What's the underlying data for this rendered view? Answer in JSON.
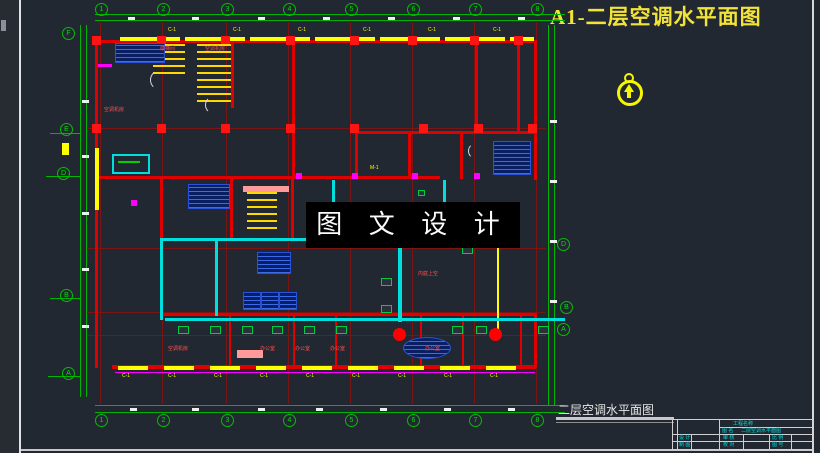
{
  "sheet": {
    "title": "A1-二层空调水平面图",
    "plan_caption": "二层空调水平面图",
    "background": "#222831",
    "accent_yellow": "#f2e338",
    "accent_green": "#00b400",
    "accent_red": "#e00000",
    "accent_cyan": "#00dede"
  },
  "watermark": {
    "text": "图 文 设 计"
  },
  "north_arrow": {
    "name": "north-arrow",
    "color": "#f6f600"
  },
  "title_block": {
    "project_label": "工程名称",
    "name_label": "图 名",
    "drawing_name": "二层空调水平面图",
    "design_label": "设 计",
    "draft_label": "制 图",
    "check_label": "审 核",
    "proof_label": "校 对",
    "scale_label": "比 例",
    "number_label": "图 号"
  },
  "axes": {
    "top_y": 3,
    "bottom_y": 414,
    "top": [
      "1",
      "2",
      "3",
      "4",
      "5",
      "6",
      "7",
      "8"
    ],
    "top_x": [
      95,
      157,
      221,
      283,
      345,
      407,
      469,
      531
    ],
    "left": [
      {
        "x": 62,
        "y": 27,
        "t": "F"
      },
      {
        "x": 60,
        "y": 123,
        "t": "E"
      },
      {
        "x": 57,
        "y": 167,
        "t": "D"
      },
      {
        "x": 60,
        "y": 289,
        "t": "B"
      },
      {
        "x": 62,
        "y": 367,
        "t": "A"
      }
    ],
    "right": [
      {
        "x": 557,
        "y": 238,
        "t": "D"
      },
      {
        "x": 560,
        "y": 301,
        "t": "B"
      },
      {
        "x": 557,
        "y": 323,
        "t": "A"
      }
    ]
  },
  "plan": {
    "vgrid": {
      "x": [
        100,
        162,
        226,
        288,
        350,
        412,
        474,
        536
      ],
      "y1": 22,
      "y2": 404
    },
    "hgrid": {
      "y": [
        128,
        248,
        312,
        335
      ],
      "x1": 88,
      "x2": 546
    },
    "shapes": [
      {
        "c": "gl",
        "b": [
          95,
          14,
          470,
          1
        ]
      },
      {
        "c": "gl",
        "b": [
          95,
          20,
          470,
          1
        ]
      },
      {
        "c": "gl",
        "b": [
          95,
          405,
          470,
          1
        ]
      },
      {
        "c": "gl",
        "b": [
          95,
          412,
          470,
          1
        ]
      },
      {
        "c": "gl",
        "b": [
          80,
          25,
          1,
          372
        ]
      },
      {
        "c": "gl",
        "b": [
          86,
          25,
          1,
          372
        ]
      },
      {
        "c": "gl",
        "b": [
          548,
          25,
          1,
          380
        ]
      },
      {
        "c": "gl",
        "b": [
          554,
          25,
          1,
          380
        ]
      },
      {
        "c": "gl",
        "b": [
          50,
          133,
          30,
          1
        ]
      },
      {
        "c": "gl",
        "b": [
          46,
          176,
          34,
          1
        ]
      },
      {
        "c": "gl",
        "b": [
          50,
          298,
          30,
          1
        ]
      },
      {
        "c": "gl",
        "b": [
          48,
          376,
          32,
          1
        ]
      },
      {
        "c": "wall",
        "b": [
          95,
          40,
          442,
          3
        ]
      },
      {
        "c": "wall",
        "b": [
          95,
          40,
          3,
          328
        ]
      },
      {
        "c": "wall",
        "b": [
          112,
          365,
          424,
          4
        ]
      },
      {
        "c": "wall",
        "b": [
          534,
          40,
          3,
          140
        ]
      },
      {
        "c": "wall",
        "b": [
          534,
          313,
          3,
          55
        ]
      },
      {
        "c": "wall",
        "b": [
          95,
          176,
          345,
          3
        ]
      },
      {
        "c": "wall",
        "b": [
          160,
          313,
          377,
          3
        ]
      },
      {
        "c": "wall",
        "b": [
          355,
          131,
          182,
          3
        ]
      },
      {
        "c": "wall",
        "b": [
          355,
          131,
          3,
          48
        ]
      },
      {
        "c": "wall",
        "b": [
          408,
          131,
          3,
          48
        ]
      },
      {
        "c": "wall",
        "b": [
          460,
          131,
          3,
          48
        ]
      },
      {
        "c": "wall",
        "b": [
          475,
          40,
          3,
          93
        ]
      },
      {
        "c": "wall",
        "b": [
          517,
          40,
          3,
          93
        ]
      },
      {
        "c": "wall",
        "b": [
          231,
          40,
          3,
          68
        ]
      },
      {
        "c": "wall",
        "b": [
          292,
          40,
          3,
          139
        ]
      },
      {
        "c": "wall",
        "b": [
          160,
          176,
          3,
          140
        ]
      },
      {
        "c": "wall",
        "b": [
          230,
          176,
          3,
          64
        ]
      },
      {
        "c": "wall",
        "b": [
          291,
          176,
          3,
          64
        ]
      },
      {
        "c": "wall",
        "b": [
          229,
          313,
          2,
          53
        ]
      },
      {
        "c": "wall",
        "b": [
          293,
          313,
          2,
          53
        ]
      },
      {
        "c": "wall",
        "b": [
          335,
          313,
          2,
          53
        ]
      },
      {
        "c": "wall",
        "b": [
          420,
          313,
          2,
          53
        ]
      },
      {
        "c": "wall",
        "b": [
          462,
          313,
          2,
          53
        ]
      },
      {
        "c": "wall",
        "b": [
          520,
          313,
          2,
          53
        ]
      },
      {
        "c": "yw",
        "b": [
          120,
          37,
          60,
          4
        ]
      },
      {
        "c": "yw",
        "b": [
          185,
          37,
          60,
          4
        ]
      },
      {
        "c": "yw",
        "b": [
          250,
          37,
          60,
          4
        ]
      },
      {
        "c": "yw",
        "b": [
          315,
          37,
          60,
          4
        ]
      },
      {
        "c": "yw",
        "b": [
          380,
          37,
          60,
          4
        ]
      },
      {
        "c": "yw",
        "b": [
          445,
          37,
          60,
          4
        ]
      },
      {
        "c": "yw",
        "b": [
          510,
          37,
          24,
          4
        ]
      },
      {
        "c": "yw",
        "b": [
          118,
          366,
          30,
          4
        ]
      },
      {
        "c": "yw",
        "b": [
          164,
          366,
          30,
          4
        ]
      },
      {
        "c": "yw",
        "b": [
          210,
          366,
          30,
          4
        ]
      },
      {
        "c": "yw",
        "b": [
          256,
          366,
          30,
          4
        ]
      },
      {
        "c": "yw",
        "b": [
          302,
          366,
          30,
          4
        ]
      },
      {
        "c": "yw",
        "b": [
          348,
          366,
          30,
          4
        ]
      },
      {
        "c": "yw",
        "b": [
          394,
          366,
          30,
          4
        ]
      },
      {
        "c": "yw",
        "b": [
          440,
          366,
          30,
          4
        ]
      },
      {
        "c": "yw",
        "b": [
          486,
          366,
          30,
          4
        ]
      },
      {
        "c": "yw",
        "b": [
          95,
          148,
          4,
          62
        ]
      },
      {
        "c": "yw",
        "b": [
          497,
          248,
          2,
          82
        ]
      },
      {
        "c": "yw",
        "b": [
          62,
          143,
          7,
          12
        ]
      },
      {
        "c": "mag",
        "b": [
          115,
          372,
          420,
          1
        ]
      },
      {
        "c": "mag",
        "b": [
          296,
          173,
          6,
          6
        ]
      },
      {
        "c": "mag",
        "b": [
          352,
          173,
          6,
          6
        ]
      },
      {
        "c": "mag",
        "b": [
          412,
          173,
          6,
          6
        ]
      },
      {
        "c": "mag",
        "b": [
          474,
          173,
          6,
          6
        ]
      },
      {
        "c": "mag",
        "b": [
          131,
          200,
          6,
          6
        ]
      },
      {
        "c": "mag",
        "b": [
          98,
          64,
          14,
          3
        ]
      },
      {
        "c": "col",
        "b": [
          92,
          36
        ]
      },
      {
        "c": "col",
        "b": [
          157,
          36
        ]
      },
      {
        "c": "col",
        "b": [
          221,
          36
        ]
      },
      {
        "c": "col",
        "b": [
          286,
          36
        ]
      },
      {
        "c": "col",
        "b": [
          350,
          36
        ]
      },
      {
        "c": "col",
        "b": [
          408,
          36
        ]
      },
      {
        "c": "col",
        "b": [
          470,
          36
        ]
      },
      {
        "c": "col",
        "b": [
          514,
          36
        ]
      },
      {
        "c": "col",
        "b": [
          92,
          124
        ]
      },
      {
        "c": "col",
        "b": [
          157,
          124
        ]
      },
      {
        "c": "col",
        "b": [
          221,
          124
        ]
      },
      {
        "c": "col",
        "b": [
          286,
          124
        ]
      },
      {
        "c": "col",
        "b": [
          350,
          124
        ]
      },
      {
        "c": "col",
        "b": [
          419,
          124
        ]
      },
      {
        "c": "col",
        "b": [
          474,
          124
        ]
      },
      {
        "c": "col",
        "b": [
          528,
          124
        ]
      },
      {
        "c": "stair",
        "b": [
          153,
          44,
          32,
          34
        ]
      },
      {
        "c": "stair",
        "b": [
          197,
          44,
          34,
          58
        ]
      },
      {
        "c": "stair",
        "b": [
          247,
          192,
          30,
          42
        ]
      },
      {
        "c": "pink",
        "b": [
          243,
          186,
          46,
          6
        ]
      },
      {
        "c": "pink",
        "b": [
          237,
          350,
          26,
          8
        ]
      },
      {
        "c": "pipe",
        "b": [
          160,
          238,
          281,
          3
        ]
      },
      {
        "c": "pipe",
        "b": [
          160,
          240,
          3,
          80
        ]
      },
      {
        "c": "pipe",
        "b": [
          215,
          240,
          3,
          76
        ]
      },
      {
        "c": "pipe",
        "b": [
          332,
          180,
          3,
          58
        ]
      },
      {
        "c": "pipe",
        "b": [
          165,
          318,
          400,
          3
        ]
      },
      {
        "c": "pipe",
        "b": [
          398,
          236,
          4,
          86
        ]
      },
      {
        "c": "pipe",
        "b": [
          443,
          180,
          3,
          57
        ]
      },
      {
        "c": "cyr",
        "b": [
          112,
          154,
          34,
          16
        ]
      },
      {
        "c": "grl",
        "b": [
          118,
          161,
          22,
          2
        ]
      },
      {
        "c": "hatch",
        "b": [
          115,
          43,
          48,
          18
        ]
      },
      {
        "c": "hatch",
        "b": [
          188,
          184,
          40,
          23
        ]
      },
      {
        "c": "hatch",
        "b": [
          257,
          252,
          32,
          20
        ]
      },
      {
        "c": "hatch",
        "b": [
          493,
          141,
          36,
          32
        ]
      },
      {
        "c": "hatch",
        "b": [
          243,
          292,
          16,
          16
        ]
      },
      {
        "c": "hatch",
        "b": [
          261,
          292,
          16,
          16
        ]
      },
      {
        "c": "hatch",
        "b": [
          279,
          292,
          16,
          16
        ]
      },
      {
        "c": "hatch ell",
        "b": [
          403,
          337,
          46,
          20
        ]
      },
      {
        "c": "dot",
        "b": [
          393,
          328
        ]
      },
      {
        "c": "dot",
        "b": [
          489,
          328
        ]
      },
      {
        "c": "fc",
        "b": [
          178,
          326
        ]
      },
      {
        "c": "fc",
        "b": [
          210,
          326
        ]
      },
      {
        "c": "fc",
        "b": [
          242,
          326
        ]
      },
      {
        "c": "fc",
        "b": [
          272,
          326
        ]
      },
      {
        "c": "fc",
        "b": [
          304,
          326
        ]
      },
      {
        "c": "fc",
        "b": [
          336,
          326
        ]
      },
      {
        "c": "fc",
        "b": [
          452,
          326
        ]
      },
      {
        "c": "fc",
        "b": [
          476,
          326
        ]
      },
      {
        "c": "fc",
        "b": [
          538,
          326
        ]
      },
      {
        "c": "fc",
        "b": [
          381,
          278
        ]
      },
      {
        "c": "fc",
        "b": [
          381,
          305
        ]
      },
      {
        "c": "fc",
        "b": [
          458,
          228
        ]
      },
      {
        "c": "fc",
        "b": [
          462,
          246
        ]
      },
      {
        "c": "fc",
        "b": [
          418,
          190,
          5,
          4
        ]
      },
      {
        "c": "arc",
        "b": [
          150,
          70,
          18,
          18
        ]
      },
      {
        "c": "arc",
        "b": [
          205,
          96,
          16,
          16
        ]
      },
      {
        "c": "arc",
        "b": [
          468,
          143,
          14,
          14
        ]
      },
      {
        "c": "wd",
        "b": [
          128,
          17
        ]
      },
      {
        "c": "wd",
        "b": [
          192,
          17
        ]
      },
      {
        "c": "wd",
        "b": [
          258,
          17
        ]
      },
      {
        "c": "wd",
        "b": [
          323,
          17
        ]
      },
      {
        "c": "wd",
        "b": [
          388,
          17
        ]
      },
      {
        "c": "wd",
        "b": [
          453,
          17
        ]
      },
      {
        "c": "wd",
        "b": [
          518,
          17
        ]
      },
      {
        "c": "wd",
        "b": [
          130,
          408
        ]
      },
      {
        "c": "wd",
        "b": [
          192,
          408
        ]
      },
      {
        "c": "wd",
        "b": [
          258,
          408
        ]
      },
      {
        "c": "wd",
        "b": [
          316,
          408
        ]
      },
      {
        "c": "wd",
        "b": [
          380,
          408
        ]
      },
      {
        "c": "wd",
        "b": [
          444,
          408
        ]
      },
      {
        "c": "wd",
        "b": [
          508,
          408
        ]
      },
      {
        "c": "wd",
        "b": [
          82,
          100
        ]
      },
      {
        "c": "wd",
        "b": [
          82,
          155
        ]
      },
      {
        "c": "wd",
        "b": [
          82,
          212
        ]
      },
      {
        "c": "wd",
        "b": [
          82,
          268
        ]
      },
      {
        "c": "wd",
        "b": [
          82,
          325
        ]
      },
      {
        "c": "wd",
        "b": [
          550,
          120
        ]
      },
      {
        "c": "wd",
        "b": [
          550,
          180
        ]
      },
      {
        "c": "wd",
        "b": [
          550,
          240
        ]
      },
      {
        "c": "wd",
        "b": [
          550,
          300
        ]
      }
    ],
    "labels": [
      {
        "c": "lr",
        "b": [
          104,
          108
        ],
        "t": "空调机房"
      },
      {
        "c": "lr",
        "b": [
          160,
          47
        ],
        "t": "楼梯间"
      },
      {
        "c": "lr",
        "b": [
          205,
          47
        ],
        "t": "空调机房"
      },
      {
        "c": "lr",
        "b": [
          418,
          272
        ],
        "t": "内庭上空"
      },
      {
        "c": "lr",
        "b": [
          168,
          347
        ],
        "t": "空调机房"
      },
      {
        "c": "lr",
        "b": [
          260,
          347
        ],
        "t": "办公室"
      },
      {
        "c": "lr",
        "b": [
          295,
          347
        ],
        "t": "办公室"
      },
      {
        "c": "lr",
        "b": [
          330,
          347
        ],
        "t": "办公室"
      },
      {
        "c": "lr",
        "b": [
          425,
          347
        ],
        "t": "办公室"
      },
      {
        "c": "ly",
        "b": [
          168,
          28
        ],
        "t": "C-1"
      },
      {
        "c": "ly",
        "b": [
          233,
          28
        ],
        "t": "C-1"
      },
      {
        "c": "ly",
        "b": [
          298,
          28
        ],
        "t": "C-1"
      },
      {
        "c": "ly",
        "b": [
          363,
          28
        ],
        "t": "C-1"
      },
      {
        "c": "ly",
        "b": [
          428,
          28
        ],
        "t": "C-1"
      },
      {
        "c": "ly",
        "b": [
          493,
          28
        ],
        "t": "C-1"
      },
      {
        "c": "ly",
        "b": [
          122,
          374
        ],
        "t": "C-1"
      },
      {
        "c": "ly",
        "b": [
          168,
          374
        ],
        "t": "C-1"
      },
      {
        "c": "ly",
        "b": [
          214,
          374
        ],
        "t": "C-1"
      },
      {
        "c": "ly",
        "b": [
          260,
          374
        ],
        "t": "C-1"
      },
      {
        "c": "ly",
        "b": [
          306,
          374
        ],
        "t": "C-1"
      },
      {
        "c": "ly",
        "b": [
          352,
          374
        ],
        "t": "C-1"
      },
      {
        "c": "ly",
        "b": [
          398,
          374
        ],
        "t": "C-1"
      },
      {
        "c": "ly",
        "b": [
          444,
          374
        ],
        "t": "C-1"
      },
      {
        "c": "ly",
        "b": [
          490,
          374
        ],
        "t": "C-1"
      },
      {
        "c": "ly",
        "b": [
          370,
          166
        ],
        "t": "M-1"
      }
    ]
  }
}
